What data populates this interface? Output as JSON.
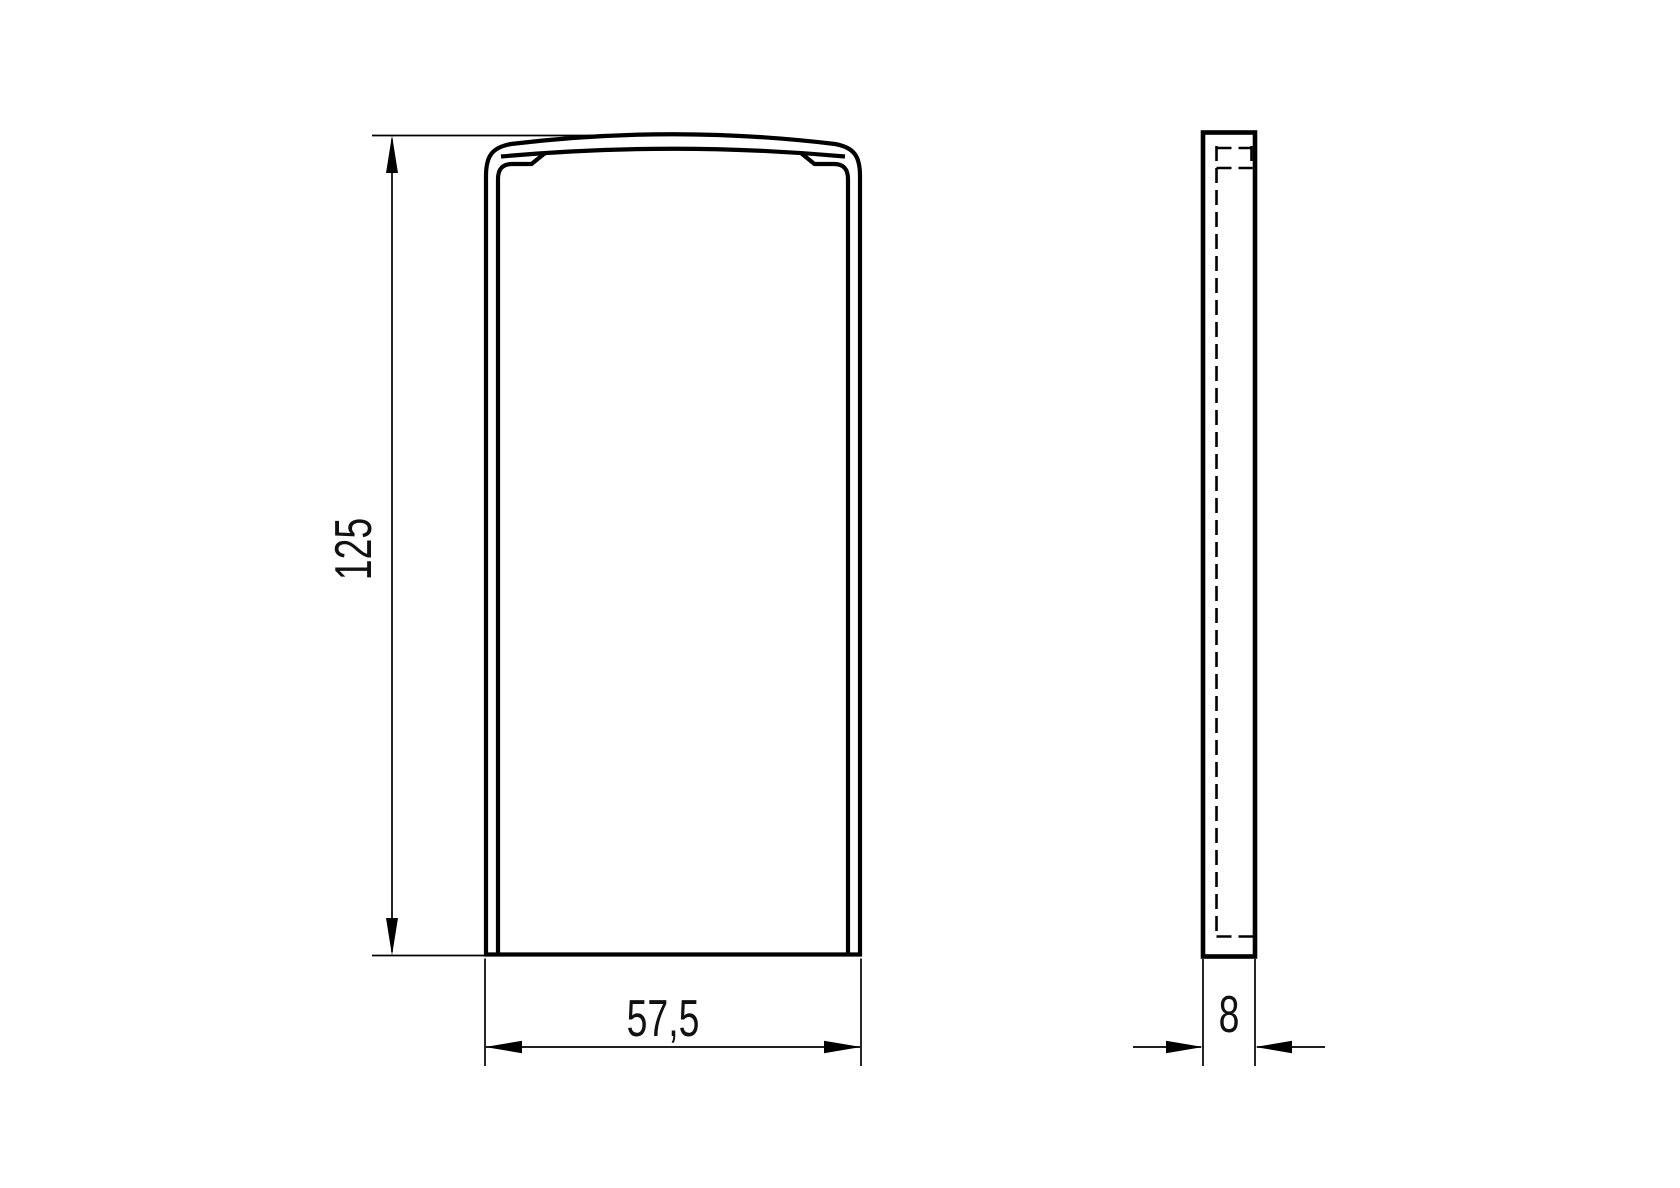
{
  "drawing": {
    "type": "technical-drawing",
    "background_color": "#ffffff",
    "line_color": "#000000",
    "text_color": "#111111",
    "views": [
      {
        "id": "front-view",
        "description": "front outline of profile end cap with curved top and inner lip"
      },
      {
        "id": "side-view",
        "description": "thin side profile with hidden (dashed) lines"
      }
    ],
    "dimensions": {
      "height": {
        "label": "125"
      },
      "width": {
        "label": "57,5"
      },
      "thickness": {
        "label": "8"
      }
    }
  }
}
